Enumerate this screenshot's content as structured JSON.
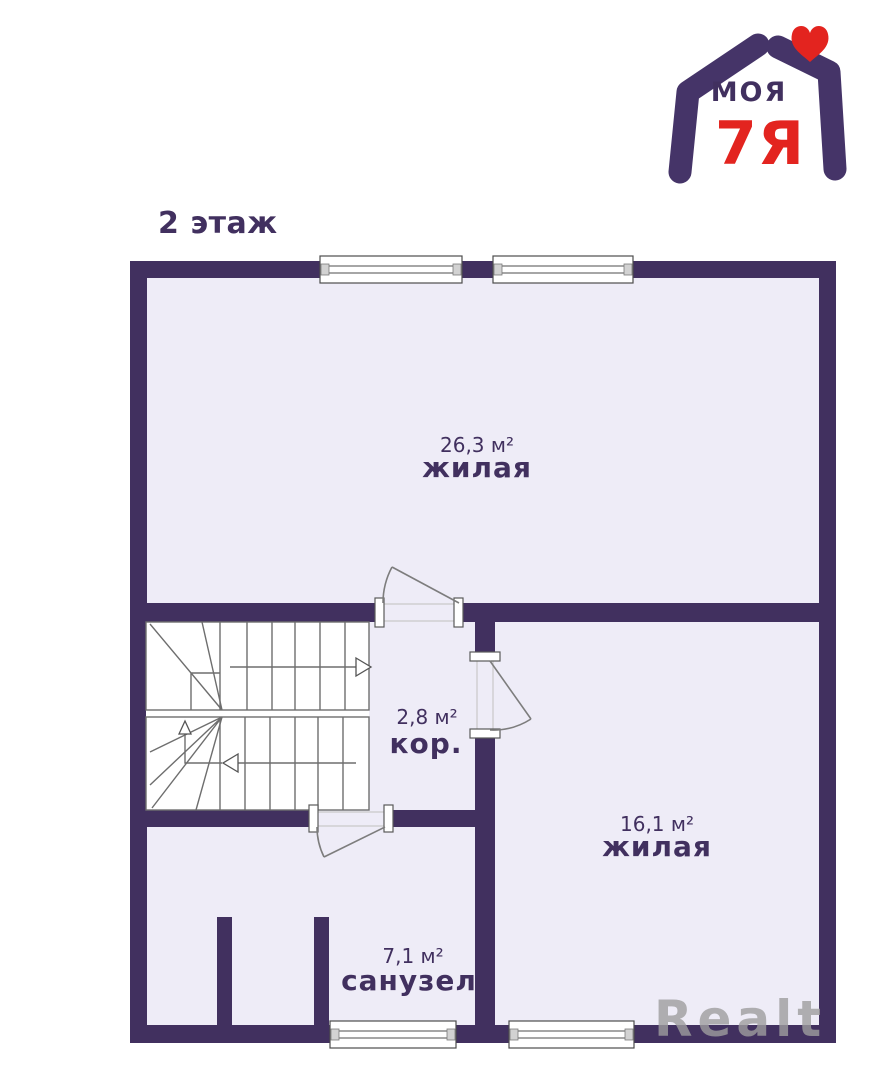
{
  "page": {
    "title": "2 этаж"
  },
  "logo": {
    "brand_top": "МОЯ",
    "brand_bottom": "7Я"
  },
  "rooms": [
    {
      "area": "26,3 м²",
      "name": "жилая"
    },
    {
      "area": "2,8 м²",
      "name": "кор."
    },
    {
      "area": "16,1 м²",
      "name": "жилая"
    },
    {
      "area": "7,1 м²",
      "name": "санузел"
    }
  ],
  "watermark": "Realt",
  "colors": {
    "wall_purple": "#41305f",
    "floor_fill": "#eeecf7",
    "logo_red": "#e3241f",
    "watermark_gray": "#9e9e9e"
  }
}
